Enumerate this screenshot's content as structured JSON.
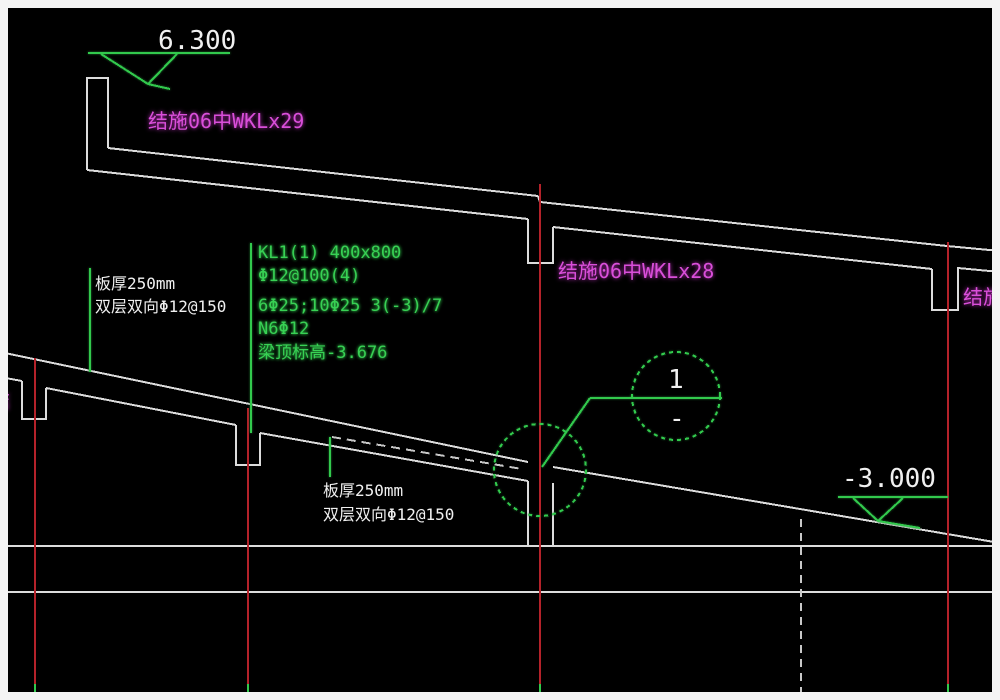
{
  "drawing_type": "structural ramp section (CAD screenshot)",
  "colors": {
    "canvas_background": "#000000",
    "frame": "#f4f4f4",
    "outline_white": "#dcdcdc",
    "gridline_red": "#b4222a",
    "annotation_green": "#32c94d",
    "reference_magenta": "#d04ad0",
    "text_white": "#f0f0f0"
  },
  "annotations": {
    "elevation_top": "6.300",
    "elevation_bottom": "-3.000",
    "ref_top_left": "结施06中WKLx29",
    "ref_middle": "结施06中WKLx28",
    "ref_right_clipped": "结施0",
    "ref_left_clipped": "结",
    "slab_note_left": {
      "thickness": "板厚250mm",
      "rebar": "双层双向Φ12@150"
    },
    "slab_note_bottom": {
      "thickness": "板厚250mm",
      "rebar": "双层双向Φ12@150"
    },
    "beam_note": {
      "name_size": "KL1(1) 400x800",
      "stirrups": "Φ12@100(4)",
      "main_bars": "6Φ25;10Φ25 3(-3)/7",
      "side_bars": "N6Φ12",
      "top_elevation": "梁顶标高-3.676"
    },
    "section_marker": {
      "number": "1",
      "sheet": "-"
    }
  }
}
